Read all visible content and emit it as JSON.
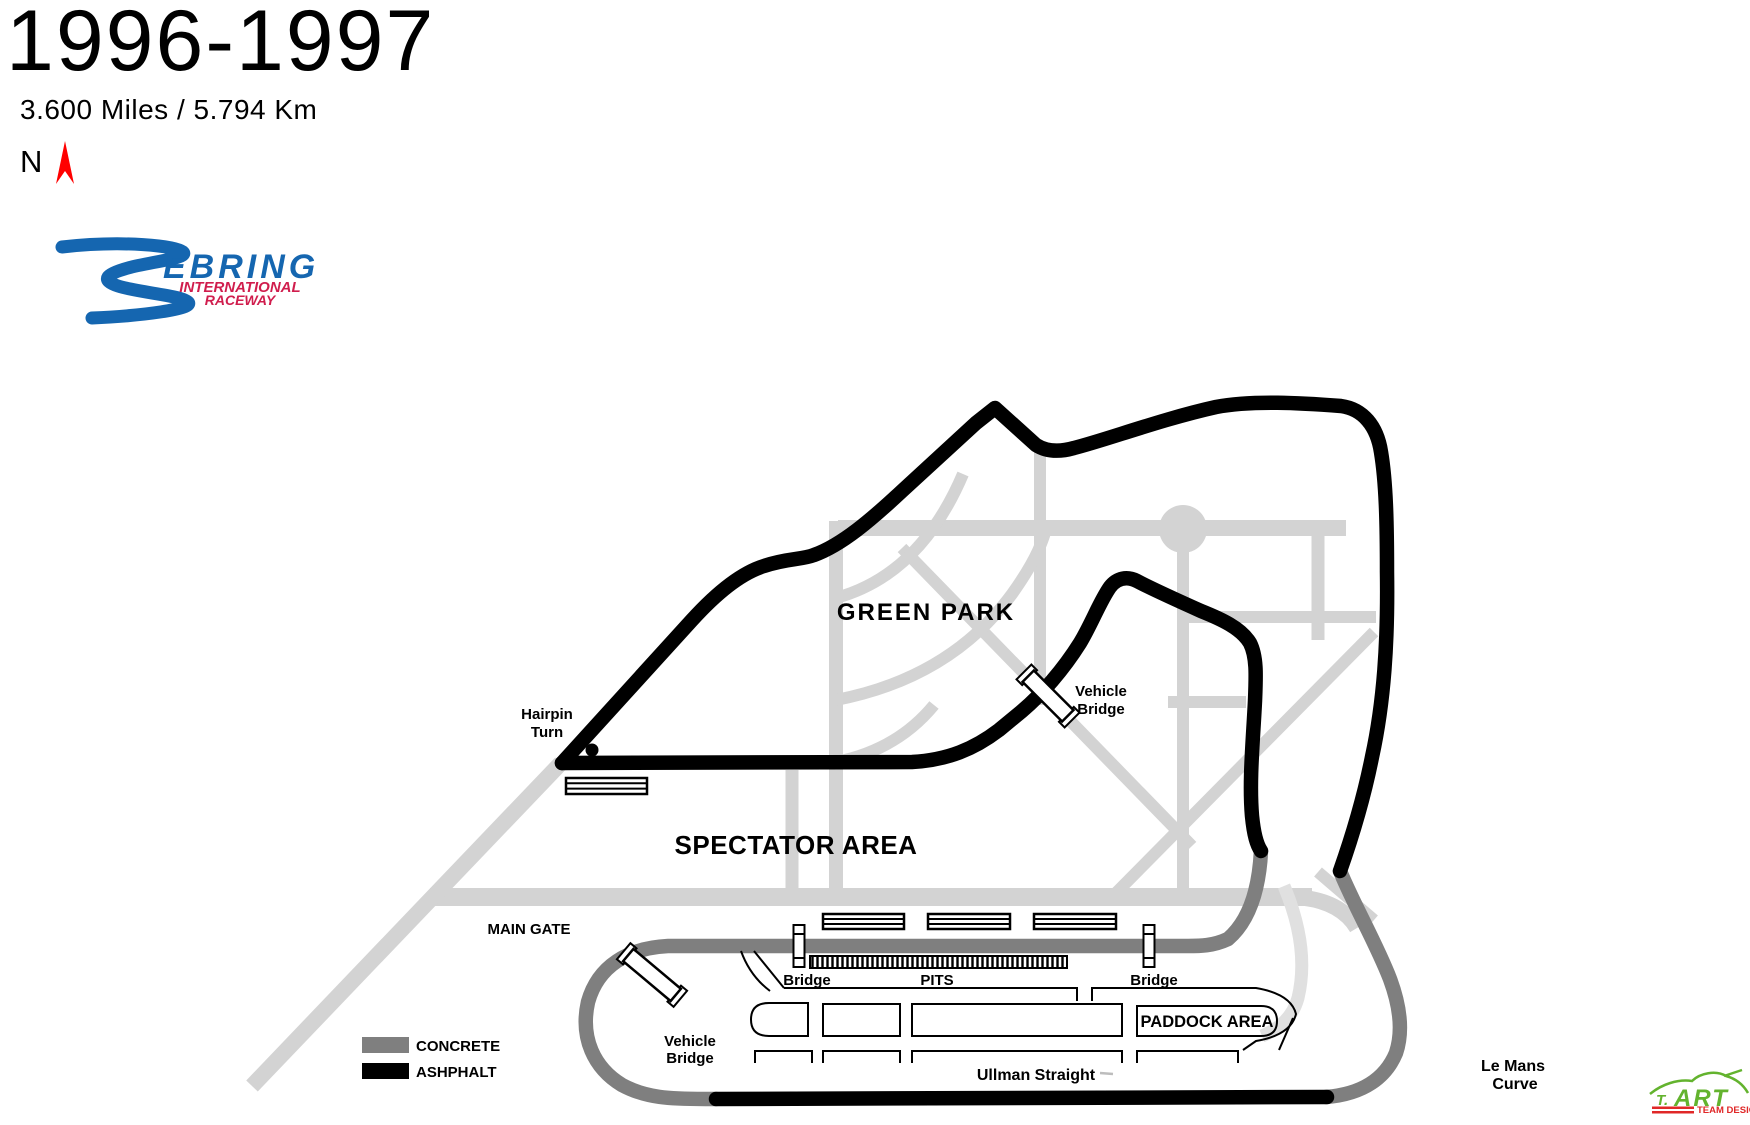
{
  "header": {
    "title": "1996-1997",
    "track_length": "3.600 Miles / 5.794 Km",
    "north_label": "N"
  },
  "logo": {
    "word": "EBRING",
    "line1": "INTERNATIONAL",
    "line2": "RACEWAY"
  },
  "legend": {
    "concrete_label": "CONCRETE",
    "asphalt_label": "ASHPHALT"
  },
  "labels": {
    "green_park": "GREEN PARK",
    "spectator_area": "SPECTATOR AREA",
    "main_gate": "MAIN GATE",
    "hairpin_1": "Hairpin",
    "hairpin_2": "Turn",
    "vehicle_1": "Vehicle",
    "vehicle_2": "Bridge",
    "gate_vehicle_1": "Vehicle",
    "gate_vehicle_2": "Bridge",
    "bridge_west": "Bridge",
    "bridge_east": "Bridge",
    "pits": "PITS",
    "paddock_area": "PADDOCK AREA",
    "ullman": "Ullman Straight",
    "lemans_1": "Le Mans",
    "lemans_2": "Curve"
  },
  "credit": {
    "prefix": "T.",
    "name": "ART",
    "subtitle": "TEAM DESIGN"
  },
  "colors": {
    "asphalt": "#000000",
    "concrete": "#7f7f7f",
    "road": "#d3d3d3",
    "road_light": "#e0e0e0",
    "logo_blue": "#1566b0",
    "logo_red": "#d01d4d",
    "credit_green": "#63b32e",
    "credit_red": "#e02828",
    "north_arrow": "#ff0000"
  }
}
